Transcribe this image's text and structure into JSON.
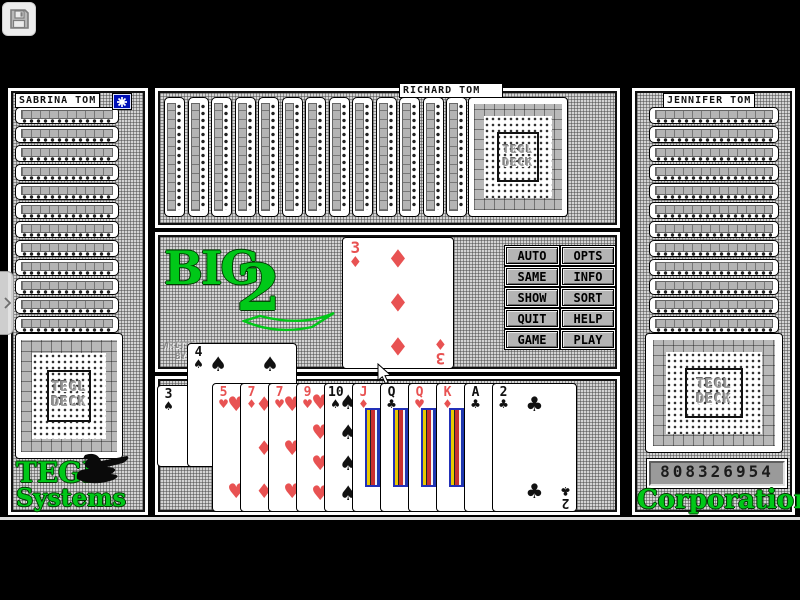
{
  "toolbar": {
    "save_icon": "floppy-disk"
  },
  "players": {
    "left": {
      "name": "SABRINA TOM",
      "hidden_card_count": 12,
      "has_turn_indicator": true
    },
    "top": {
      "name": "RICHARD TOM",
      "hidden_card_count": 13
    },
    "right": {
      "name": "JENNIFER TOM",
      "hidden_card_count": 12,
      "score_display": "808326954"
    }
  },
  "branding": {
    "game_logo_text": "BIG",
    "game_logo_number": "2",
    "credit_line1": "WRITTEN",
    "credit_line2": "BY",
    "left_footer_line1": "TEGL",
    "left_footer_line2": "Systems",
    "right_footer": "Corporation",
    "deck_label_line1": "TEGL",
    "deck_label_line2": "DECK"
  },
  "action_buttons": [
    "AUTO",
    "OPTS",
    "SAME",
    "INFO",
    "SHOW",
    "SORT",
    "QUIT",
    "HELP",
    "GAME",
    "PLAY"
  ],
  "table": {
    "played_card": {
      "rank": "3",
      "suit": "diamond"
    }
  },
  "hand": {
    "raised_cards": [
      {
        "rank": "3",
        "suit": "spade"
      },
      {
        "rank": "4",
        "suit": "spade"
      }
    ],
    "fan_cards": [
      {
        "rank": "5",
        "suit": "heart"
      },
      {
        "rank": "7",
        "suit": "diamond"
      },
      {
        "rank": "7",
        "suit": "heart"
      },
      {
        "rank": "9",
        "suit": "heart"
      },
      {
        "rank": "10",
        "suit": "spade"
      },
      {
        "rank": "J",
        "suit": "diamond"
      },
      {
        "rank": "Q",
        "suit": "club"
      },
      {
        "rank": "Q",
        "suit": "heart"
      },
      {
        "rank": "K",
        "suit": "diamond"
      },
      {
        "rank": "A",
        "suit": "club"
      },
      {
        "rank": "2",
        "suit": "club"
      }
    ]
  },
  "colors": {
    "logo_green": "#00c818",
    "turn_indicator_blue": "#0010b8",
    "card_red": "#e85252"
  }
}
